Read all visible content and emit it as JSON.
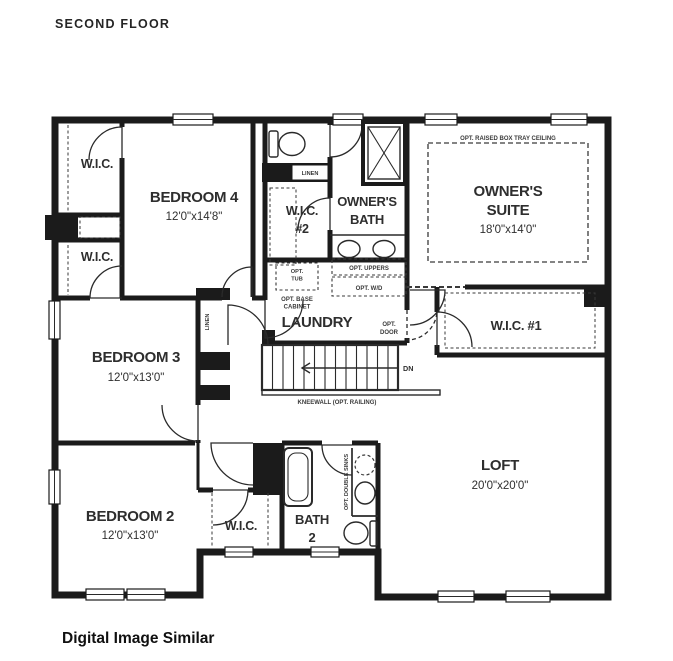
{
  "page": {
    "title": "SECOND FLOOR",
    "footer": "Digital Image Similar"
  },
  "rooms": {
    "wic_top": {
      "name": "W.I.C."
    },
    "wic_left2": {
      "name": "W.I.C."
    },
    "bedroom4": {
      "name": "BEDROOM 4",
      "dims": "12'0\"x14'8\""
    },
    "linen_upper": {
      "name": "LINEN"
    },
    "wic2": {
      "name": "W.I.C.",
      "number": "#2"
    },
    "owners_bath": {
      "name_line1": "OWNER'S",
      "name_line2": "BATH"
    },
    "owners_suite": {
      "name_line1": "OWNER'S",
      "name_line2": "SUITE",
      "dims": "18'0\"x14'0\"",
      "ceiling_note": "OPT. RAISED BOX TRAY CEILING"
    },
    "bedroom3": {
      "name": "BEDROOM 3",
      "dims": "12'0\"x13'0\""
    },
    "linen_hall": {
      "name": "LINEN"
    },
    "laundry": {
      "name": "LAUNDRY"
    },
    "wic1": {
      "name": "W.I.C. #1"
    },
    "bedroom2": {
      "name": "BEDROOM 2",
      "dims": "12'0\"x13'0\""
    },
    "wic_bedroom2": {
      "name": "W.I.C."
    },
    "bath2": {
      "name_line1": "BATH",
      "name_line2": "2"
    },
    "loft": {
      "name": "LOFT",
      "dims": "20'0\"x20'0\""
    }
  },
  "annotations": {
    "opt_tub_line1": "OPT.",
    "opt_tub_line2": "TUB",
    "opt_base_cabinet_line1": "OPT. BASE",
    "opt_base_cabinet_line2": "CABINET",
    "opt_uppers": "OPT. UPPERS",
    "opt_wd": "OPT. W/D",
    "opt_door_line1": "OPT.",
    "opt_door_line2": "DOOR",
    "down": "DN",
    "kneewall": "KNEEWALL (OPT. RAILING)",
    "opt_double_sinks": "OPT. DOUBLE SINKS"
  },
  "colors": {
    "wall": "#1b1b1b",
    "text": "#2e2e2e",
    "background": "#ffffff"
  }
}
